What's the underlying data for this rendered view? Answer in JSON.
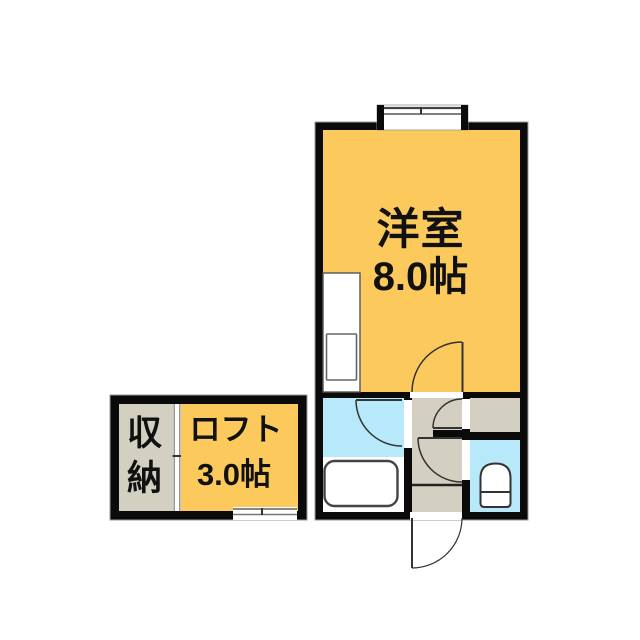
{
  "floor_plan": {
    "labels": {
      "main_room_name": "洋室",
      "main_room_size": "8.0帖",
      "loft_name": "ロフト",
      "loft_size": "3.0帖",
      "storage_name": "収納"
    },
    "rooms": [
      {
        "id": "main_room",
        "name": "洋室",
        "size_label": "8.0帖",
        "floor_color": "#FCC95C"
      },
      {
        "id": "loft",
        "name": "ロフト",
        "size_label": "3.0帖",
        "floor_color": "#FCC95C"
      },
      {
        "id": "storage",
        "name": "収納",
        "floor_color": "#D3CFC1"
      },
      {
        "id": "bathroom",
        "floor_color": "#B7E9FA"
      },
      {
        "id": "toilet_room",
        "floor_color": "#B7E9FA"
      },
      {
        "id": "hallway_entrance",
        "floor_color": "#D3CFC1"
      },
      {
        "id": "entry_closet",
        "floor_color": "#D3CFC1"
      }
    ],
    "colors": {
      "room_fill": "#FCC95C",
      "wet_fill": "#B7E9FA",
      "hall_fill": "#D3CFC1",
      "wall": "#0a0a0a",
      "line": "#333333",
      "background": "#FFFFFF"
    },
    "fixtures": [
      {
        "name": "bay-window"
      },
      {
        "name": "kitchen-counter"
      },
      {
        "name": "bathtub"
      },
      {
        "name": "toilet"
      },
      {
        "name": "storage-sliding-door"
      },
      {
        "name": "loft-window"
      }
    ],
    "doors": [
      {
        "name": "main-room-door",
        "type": "swing"
      },
      {
        "name": "bathroom-door",
        "type": "swing"
      },
      {
        "name": "closet-door",
        "type": "swing"
      },
      {
        "name": "toilet-door",
        "type": "swing"
      },
      {
        "name": "entrance-door",
        "type": "swing-outward"
      }
    ]
  }
}
